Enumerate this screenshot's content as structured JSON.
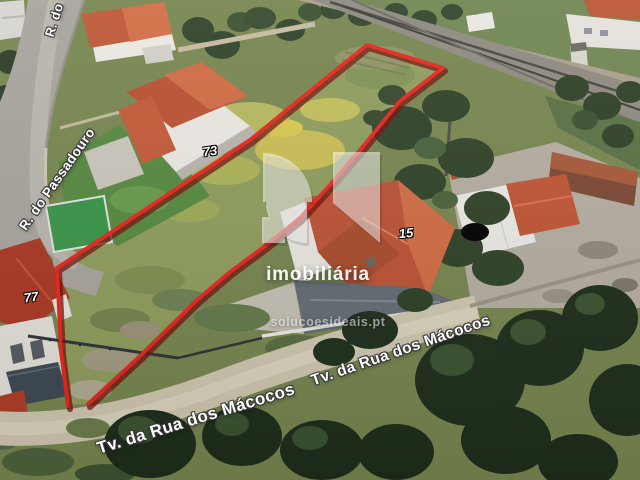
{
  "scene": {
    "type": "aerial-satellite-photo-of-land-plot",
    "boundary_color": "#e8251c"
  },
  "labels": {
    "street_top": "R. do",
    "street_left": "R. do Passadouro",
    "street_bottom_near": "Tv. da Rua dos Mácocos",
    "street_bottom_far": "Tv. da Rua dos Mácocos",
    "number_73": "73",
    "number_77": "77",
    "number_15": "15"
  },
  "watermark": {
    "brand": "imobiliária",
    "website": "solucoesideais.pt"
  }
}
